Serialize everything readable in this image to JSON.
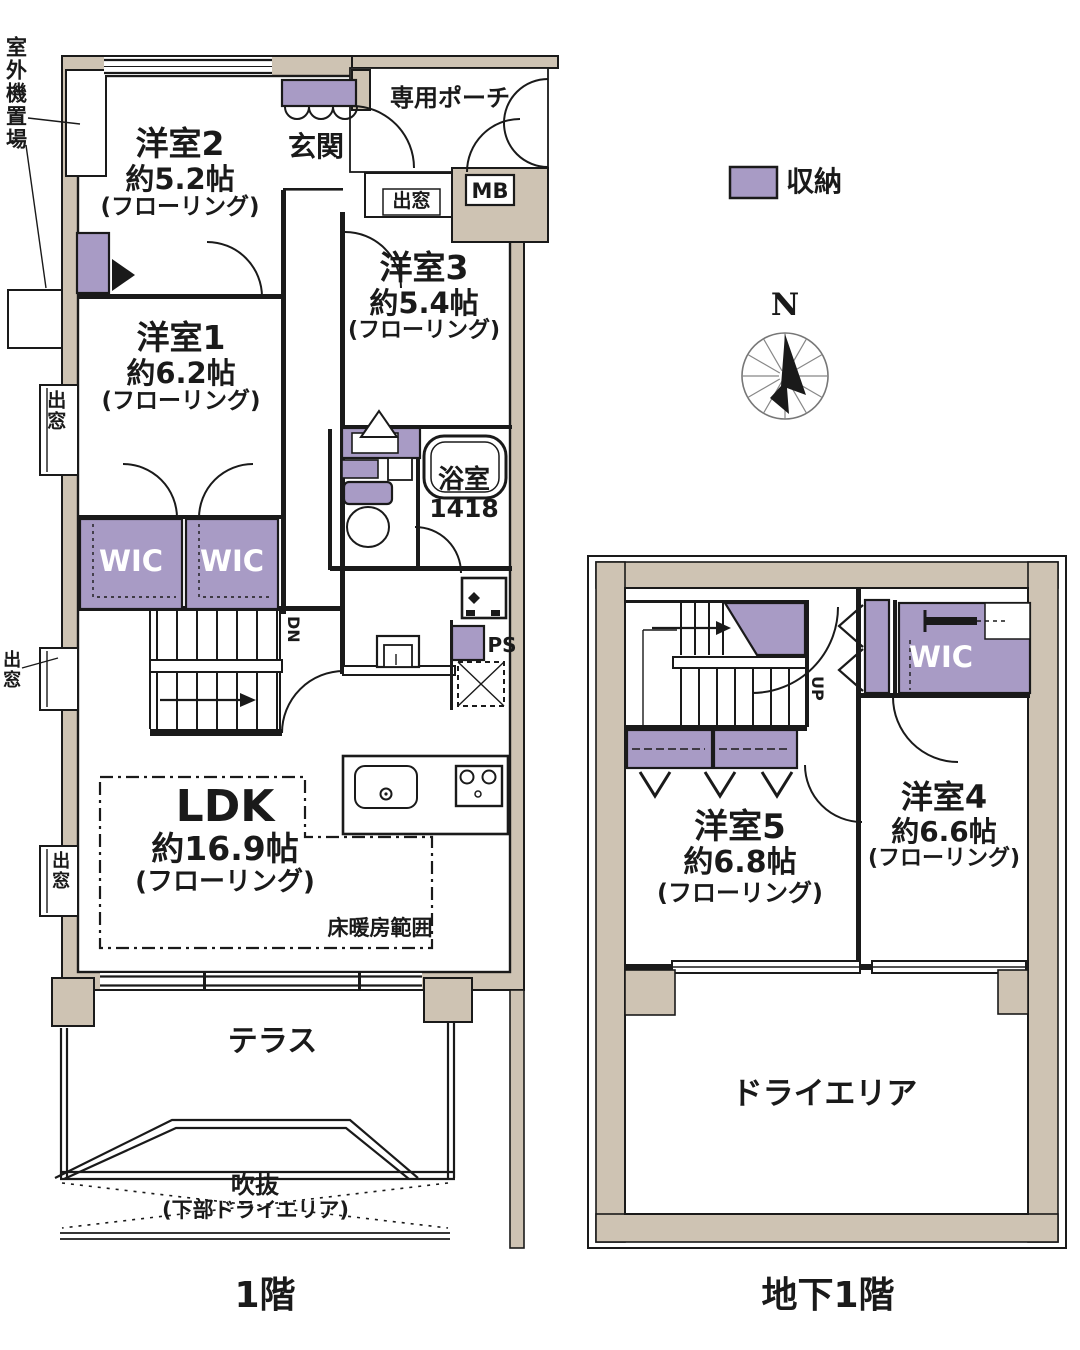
{
  "legend": {
    "storage_label": "収納"
  },
  "compass": {
    "north_label": "N"
  },
  "floor1": {
    "floor_label": "1階",
    "outdoor_unit_label": "室外機置場",
    "entrance_label": "玄関",
    "porch_label": "専用ポーチ",
    "meter_box_label": "MB",
    "bay_window_top_label": "出窓",
    "bay_window_left1_label": "出窓",
    "bay_window_left2_label": "出窓",
    "bay_window_left3_label": "出窓",
    "room2": {
      "name": "洋室2",
      "size": "約5.2帖",
      "flooring": "(フローリング)"
    },
    "room3": {
      "name": "洋室3",
      "size": "約5.4帖",
      "flooring": "(フローリング)"
    },
    "room1": {
      "name": "洋室1",
      "size": "約6.2帖",
      "flooring": "(フローリング)"
    },
    "wic_left_label": "WIC",
    "wic_right_label": "WIC",
    "bathroom": {
      "name": "浴室",
      "size": "1418"
    },
    "stairs_down_label": "DN",
    "pipe_space_label": "PS",
    "ldk": {
      "name": "LDK",
      "size": "約16.9帖",
      "flooring": "(フローリング)"
    },
    "floor_heating_label": "床暖房範囲",
    "terrace_label": "テラス",
    "void_label": "吹抜",
    "void_sub_label": "(下部ドライエリア)"
  },
  "basement": {
    "floor_label": "地下1階",
    "stairs_up_label": "UP",
    "wic_label": "WIC",
    "room5": {
      "name": "洋室5",
      "size": "約6.8帖",
      "flooring": "(フローリング)"
    },
    "room4": {
      "name": "洋室4",
      "size": "約6.6帖",
      "flooring": "(フローリング)"
    },
    "dry_area_label": "ドライエリア"
  },
  "colors": {
    "wall": "#cec3b3",
    "storage": "#a89bc5",
    "line": "#1a1a1a"
  }
}
